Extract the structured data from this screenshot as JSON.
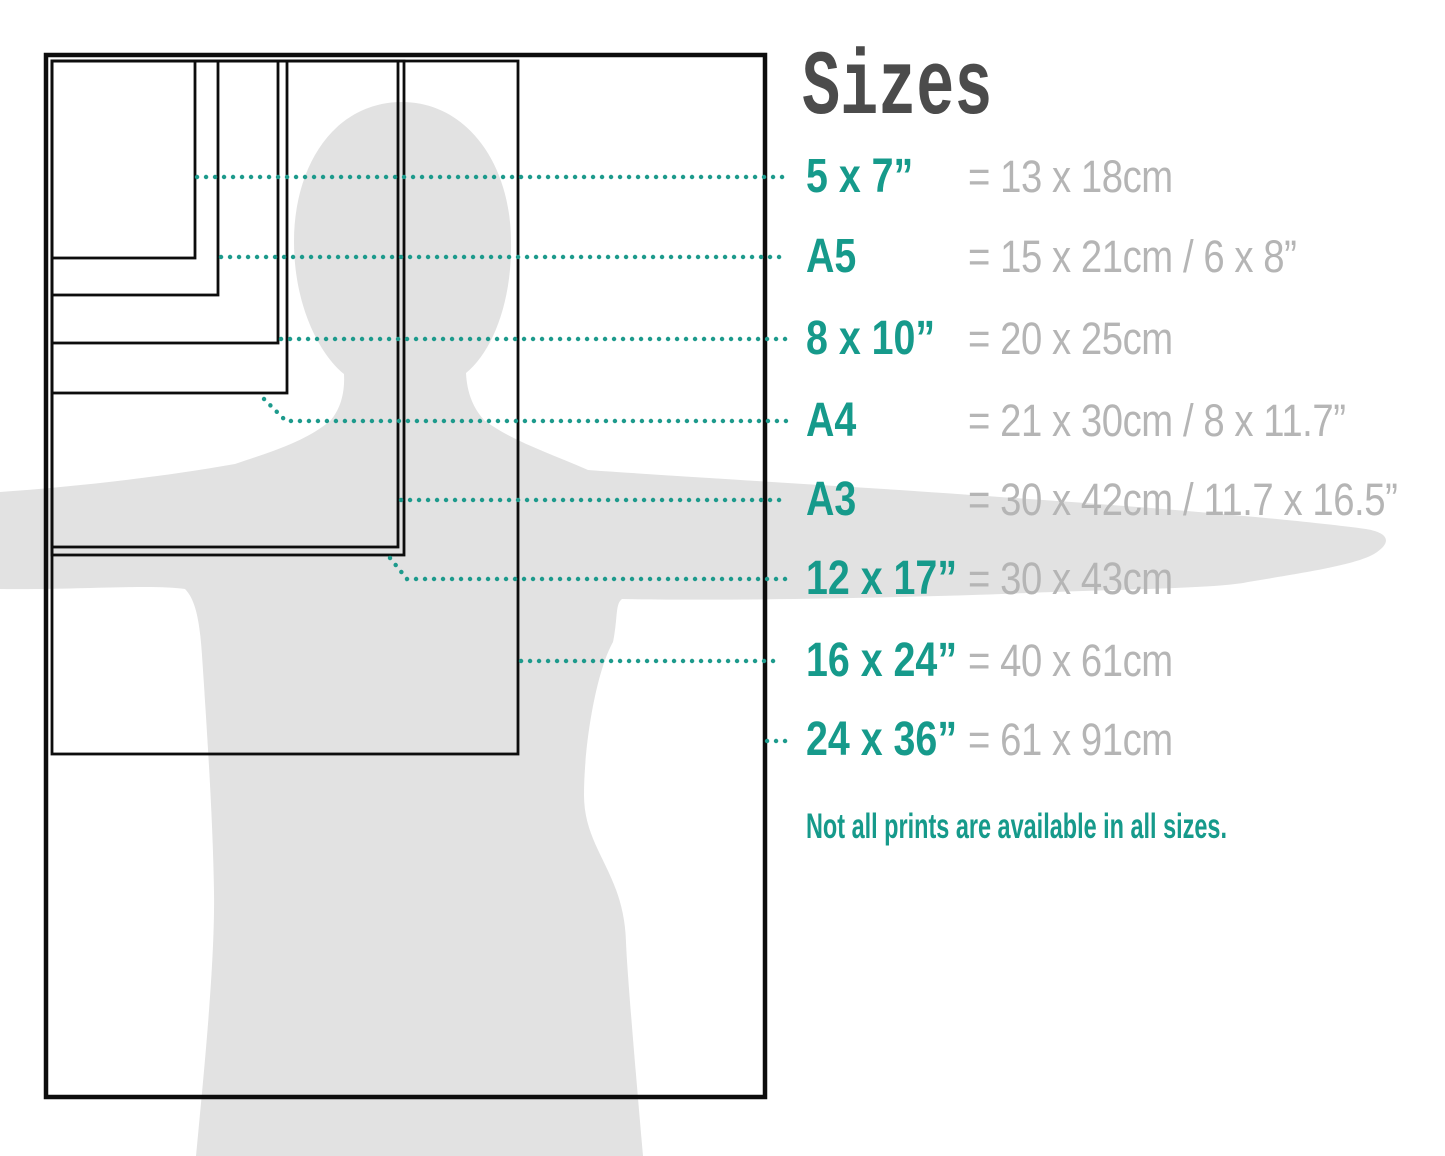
{
  "title": "Sizes",
  "note": "Not all prints are available in all sizes.",
  "colors": {
    "accent_teal": "#169a8b",
    "dotted_line": "#1d9a8c",
    "value_gray": "#b5b5b5",
    "title_gray": "#4b4b4b",
    "silhouette_gray": "#e2e2e2",
    "outline_black": "#0d0d0d"
  },
  "rows": [
    {
      "label": "5 x 7”",
      "value": "= 13 x 18cm"
    },
    {
      "label": "A5",
      "value": "= 15 x 21cm / 6 x 8”"
    },
    {
      "label": "8 x 10”",
      "value": "= 20 x 25cm"
    },
    {
      "label": "A4",
      "value": "= 21 x 30cm / 8 x 11.7”"
    },
    {
      "label": "A3",
      "value": "= 30 x 42cm / 11.7 x 16.5”"
    },
    {
      "label": "12 x 17”",
      "value": "= 30 x 43cm"
    },
    {
      "label": "16 x 24”",
      "value": "= 40 x 61cm"
    },
    {
      "label": "24 x 36”",
      "value": "= 61 x 91cm"
    }
  ],
  "diagram": {
    "description": "Nested print-size rectangles over a human silhouette with outstretched arms",
    "rect_sizes": [
      "5 x 7”",
      "A5",
      "8 x 10”",
      "A4",
      "A3",
      "12 x 17”",
      "16 x 24”",
      "24 x 36”"
    ]
  }
}
